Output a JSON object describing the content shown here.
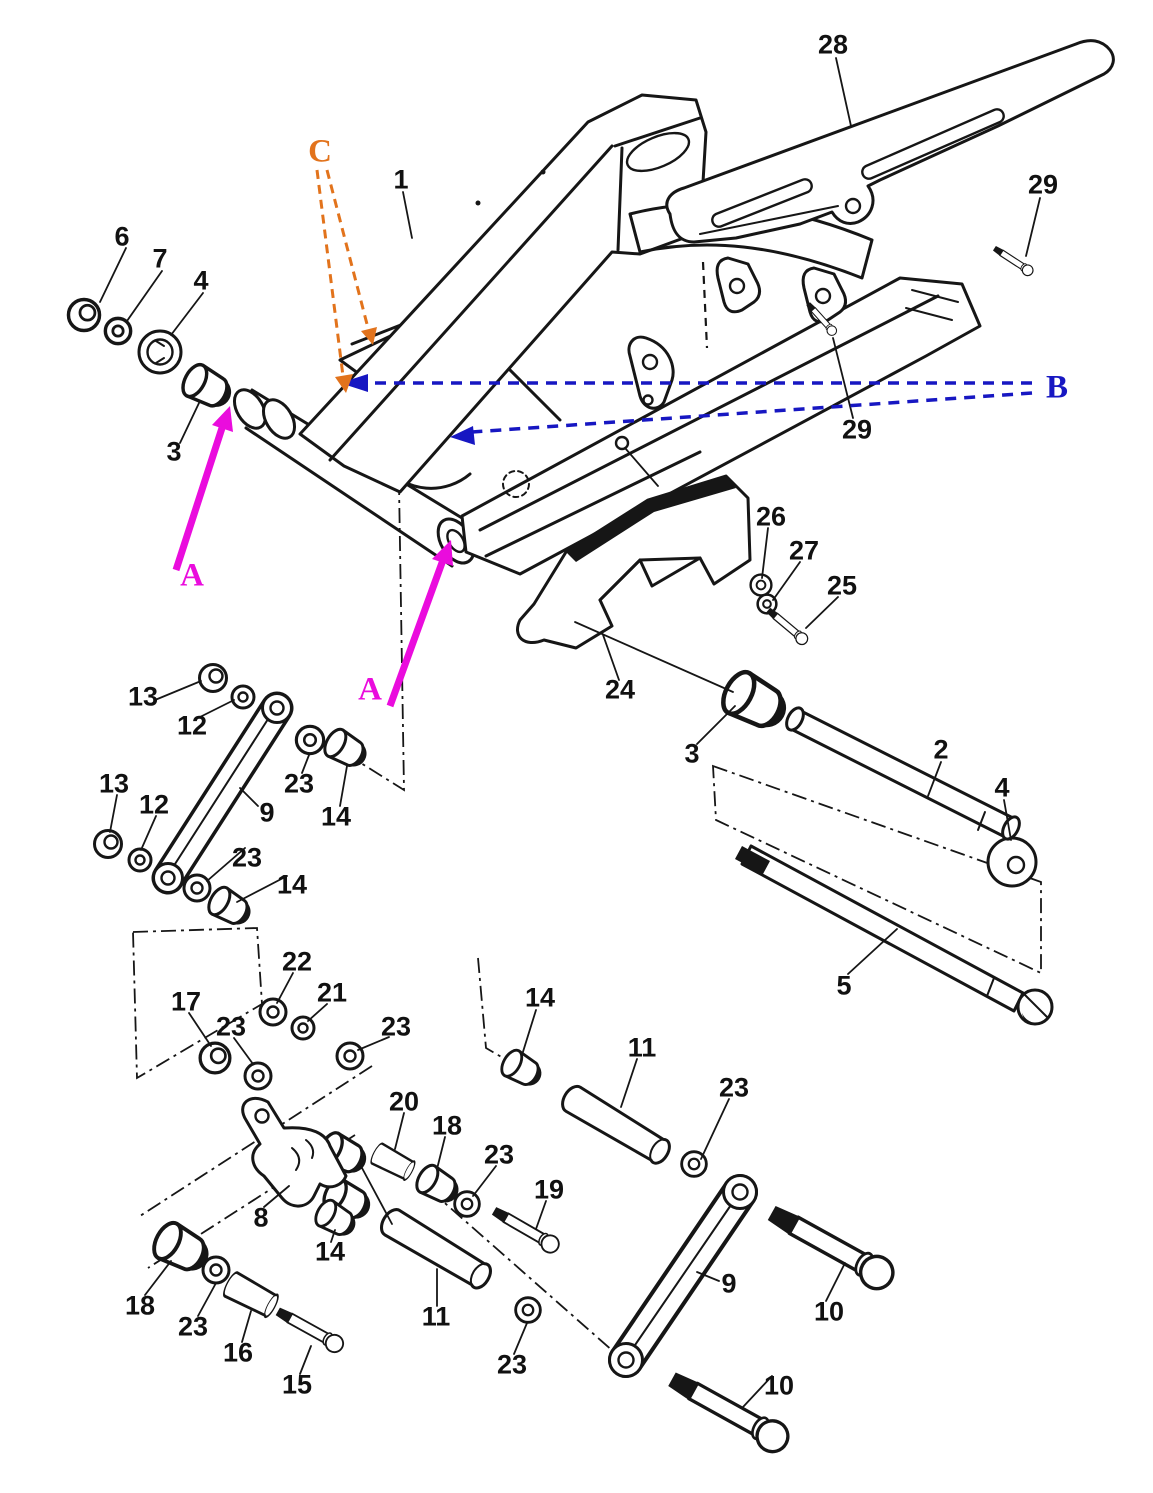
{
  "diagram": {
    "description": "Exploded parts diagram of a motorcycle swingarm and rear suspension linkage with numbered callouts and colored reference arrows",
    "colors": {
      "line": "#161616",
      "paper": "#ffffff",
      "arrow_a": "#ea0cdd",
      "arrow_b": "#1717c2",
      "arrow_c": "#e2731c"
    },
    "part_labels": [
      {
        "t": "6",
        "x": 122,
        "y": 237
      },
      {
        "t": "7",
        "x": 160,
        "y": 259
      },
      {
        "t": "4",
        "x": 201,
        "y": 281
      },
      {
        "t": "3",
        "x": 174,
        "y": 452
      },
      {
        "t": "1",
        "x": 401,
        "y": 180
      },
      {
        "t": "28",
        "x": 833,
        "y": 45
      },
      {
        "t": "29",
        "x": 1043,
        "y": 185
      },
      {
        "t": "29",
        "x": 857,
        "y": 430
      },
      {
        "t": "26",
        "x": 771,
        "y": 517
      },
      {
        "t": "27",
        "x": 804,
        "y": 551
      },
      {
        "t": "25",
        "x": 842,
        "y": 586
      },
      {
        "t": "24",
        "x": 620,
        "y": 690
      },
      {
        "t": "3",
        "x": 692,
        "y": 754
      },
      {
        "t": "2",
        "x": 941,
        "y": 750
      },
      {
        "t": "4",
        "x": 1002,
        "y": 788
      },
      {
        "t": "5",
        "x": 844,
        "y": 986
      },
      {
        "t": "13",
        "x": 143,
        "y": 697
      },
      {
        "t": "12",
        "x": 192,
        "y": 726
      },
      {
        "t": "23",
        "x": 299,
        "y": 784
      },
      {
        "t": "14",
        "x": 336,
        "y": 817
      },
      {
        "t": "9",
        "x": 267,
        "y": 813
      },
      {
        "t": "13",
        "x": 114,
        "y": 784
      },
      {
        "t": "12",
        "x": 154,
        "y": 805
      },
      {
        "t": "23",
        "x": 247,
        "y": 858
      },
      {
        "t": "14",
        "x": 292,
        "y": 885
      },
      {
        "t": "22",
        "x": 297,
        "y": 962
      },
      {
        "t": "21",
        "x": 332,
        "y": 993
      },
      {
        "t": "17",
        "x": 186,
        "y": 1002
      },
      {
        "t": "23",
        "x": 231,
        "y": 1027
      },
      {
        "t": "23",
        "x": 396,
        "y": 1027
      },
      {
        "t": "20",
        "x": 404,
        "y": 1102
      },
      {
        "t": "18",
        "x": 447,
        "y": 1126
      },
      {
        "t": "23",
        "x": 499,
        "y": 1155
      },
      {
        "t": "19",
        "x": 549,
        "y": 1190
      },
      {
        "t": "8",
        "x": 261,
        "y": 1218
      },
      {
        "t": "14",
        "x": 330,
        "y": 1252
      },
      {
        "t": "14",
        "x": 540,
        "y": 998
      },
      {
        "t": "11",
        "x": 642,
        "y": 1048
      },
      {
        "t": "23",
        "x": 734,
        "y": 1088
      },
      {
        "t": "11",
        "x": 436,
        "y": 1317
      },
      {
        "t": "16",
        "x": 238,
        "y": 1353
      },
      {
        "t": "15",
        "x": 297,
        "y": 1385
      },
      {
        "t": "18",
        "x": 140,
        "y": 1306
      },
      {
        "t": "23",
        "x": 193,
        "y": 1327
      },
      {
        "t": "9",
        "x": 729,
        "y": 1284
      },
      {
        "t": "10",
        "x": 829,
        "y": 1312
      },
      {
        "t": "10",
        "x": 779,
        "y": 1386
      },
      {
        "t": "23",
        "x": 512,
        "y": 1365
      }
    ],
    "annotations": [
      {
        "t": "C",
        "x": 320,
        "y": 152,
        "color_key": "arrow_c"
      },
      {
        "t": "B",
        "x": 1057,
        "y": 388,
        "color_key": "arrow_b"
      },
      {
        "t": "A",
        "x": 192,
        "y": 576,
        "color_key": "arrow_a"
      },
      {
        "t": "A",
        "x": 370,
        "y": 690,
        "color_key": "arrow_a"
      }
    ]
  }
}
